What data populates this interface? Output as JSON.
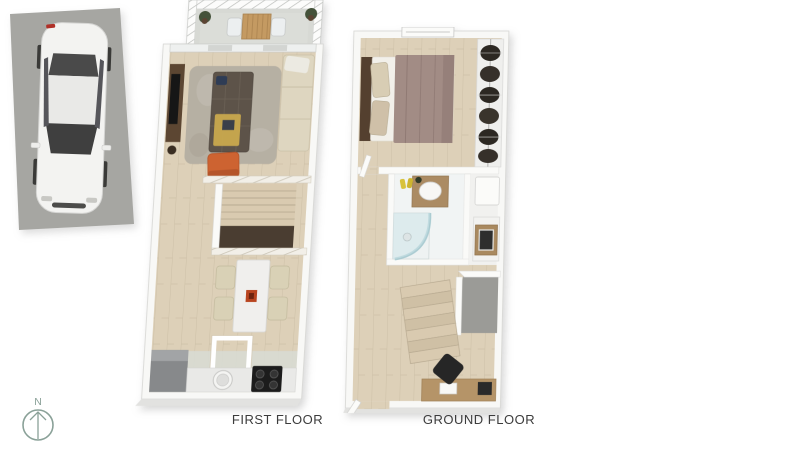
{
  "canvas": {
    "width": 805,
    "height": 453,
    "background": "#ffffff"
  },
  "labels": {
    "first_floor": "FIRST FLOOR",
    "ground_floor": "GROUND FLOOR"
  },
  "compass": {
    "letter": "N",
    "direction": "up",
    "color": "#8aa198"
  },
  "colors": {
    "wood_floor": "#ddd0b8",
    "terrace_stone": "#d7d9d4",
    "kitchen_tile": "#d8dad3",
    "wall_white": "#f8f8f6",
    "wall_edge": "#d6d6d4",
    "rug": "#b6b0a3",
    "sofa_dark": "#5d5349",
    "accent_orange": "#cd6331",
    "cream_furniture": "#d9d1b6",
    "media_unit_brown": "#5c4632",
    "bed_duvet_mauve": "#a28c85",
    "headboard_brown": "#54402f",
    "shower_glass": "#bcdade",
    "vanity_wood": "#ab8b63",
    "stair_wood": "#d9cab0",
    "stair_void": "#4a3d31",
    "parking_asphalt": "#a6a6a2",
    "car_body": "#f3f3f1",
    "car_glass": "#4a4a4a",
    "label_text": "#3c3c3c"
  },
  "plans": [
    {
      "id": "first-floor",
      "label": "FIRST FLOOR",
      "rooms": [
        "terrace",
        "living-room",
        "staircase",
        "dining-area",
        "kitchen"
      ],
      "furniture": [
        "terrace-table",
        "terrace-chairs",
        "potted-plants",
        "tv-unit",
        "tv",
        "shag-rug",
        "dark-sofa",
        "orange-armchair",
        "beige-sofa",
        "stairs-down",
        "dining-table",
        "dining-chairs",
        "floor-hatch",
        "fridge",
        "kitchen-counter",
        "sink",
        "stove"
      ]
    },
    {
      "id": "ground-floor",
      "label": "GROUND FLOOR",
      "rooms": [
        "bedroom",
        "wardrobe",
        "bathroom",
        "utility",
        "hallway",
        "staircase",
        "study-corner",
        "entrance"
      ],
      "furniture": [
        "window",
        "double-bed",
        "pillows",
        "hanging-clothes",
        "vanity-sink",
        "slippers",
        "shower",
        "toilet",
        "washing-machine",
        "stairs-up",
        "desk",
        "office-chair",
        "entrance-door"
      ]
    }
  ],
  "parking": {
    "space": "outdoor-parking-bay",
    "vehicle": "white-car-top-view"
  }
}
